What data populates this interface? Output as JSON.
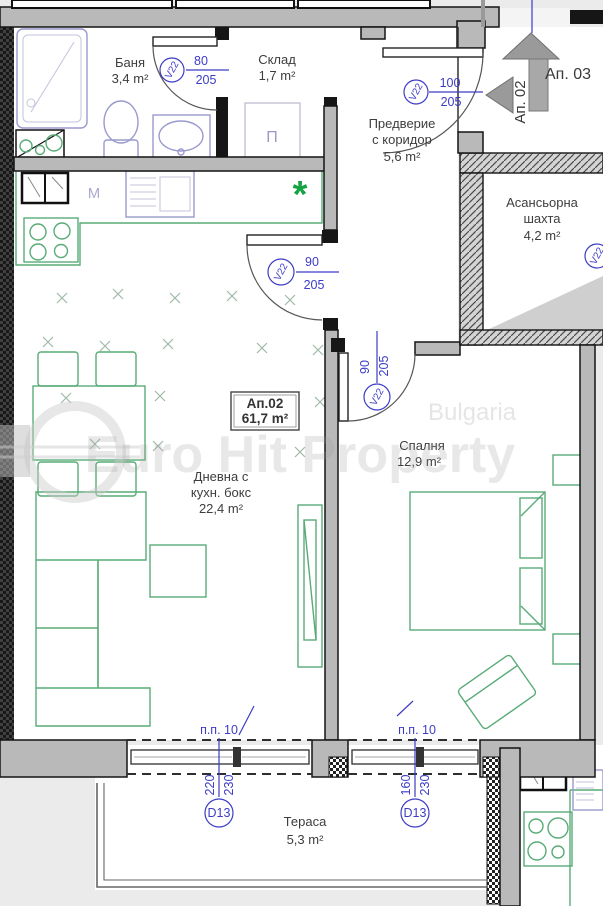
{
  "watermark": {
    "brand": "Euro Hit Property",
    "country": "Bulgaria"
  },
  "navigation": {
    "to_ap03": "Ап. 03",
    "to_ap02": "Ап. 02"
  },
  "apartment_box": {
    "id": "Ап.02",
    "area": "61,7 m²"
  },
  "rooms": {
    "bathroom": {
      "name": "Баня",
      "area": "3,4 m²"
    },
    "storage": {
      "name": "Склад",
      "area": "1,7 m²"
    },
    "hall": {
      "name_line1": "Предверие",
      "name_line2": "с коридор",
      "area": "5,6 m²"
    },
    "elevator": {
      "name_line1": "Асансьорна",
      "name_line2": "шахта",
      "area": "4,2 m²"
    },
    "living": {
      "name_line1": "Дневна с",
      "name_line2": "кухн. бокс",
      "area": "22,4 m²"
    },
    "bedroom": {
      "name": "Спалня",
      "area": "12,9 m²"
    },
    "terrace": {
      "name": "Тераса",
      "area": "5,3 m²"
    }
  },
  "doors": {
    "bathroom": {
      "tag": "V22",
      "width": "80",
      "height": "205"
    },
    "entrance": {
      "tag": "V22",
      "width": "100",
      "height": "205"
    },
    "living": {
      "tag": "V22",
      "width": "90",
      "height": "205"
    },
    "bedroom": {
      "tag": "V22",
      "width": "90",
      "height": "205"
    },
    "shaft": {
      "tag": "V22"
    },
    "terrace_living": {
      "tag": "D13",
      "width": "220",
      "height": "230",
      "parapet": "п.п. 10"
    },
    "terrace_bedroom": {
      "tag": "D13",
      "width": "160",
      "height": "230",
      "parapet": "п.п. 10"
    }
  },
  "symbols": {
    "storage_unit": "П",
    "kitchen_machine": "М",
    "fridge_marker": "*"
  },
  "colors": {
    "annotation_blue": "#3c3cc6",
    "furniture_green": "#58ab77",
    "fixture_blue": "#9a9ace",
    "wall_gray": "#b9b9b9",
    "accent_green": "#17a344"
  }
}
